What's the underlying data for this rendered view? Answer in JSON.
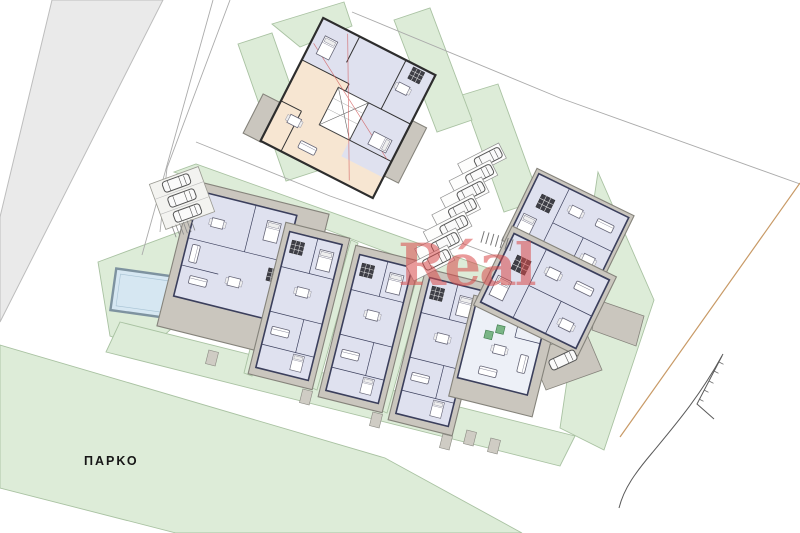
{
  "labels": {
    "park": "ΠΑΡΚΟ",
    "watermark": "Réal"
  },
  "colors": {
    "green": "#ddecd8",
    "green_border": "#a9c2a2",
    "road_gray": "#eaeaea",
    "road_border": "#bdbdbd",
    "wall_gray": "#cac6be",
    "wall_border": "#85837b",
    "floor_blue": "#dfe1ef",
    "floor_peach": "#f7e6d2",
    "plan_line": "#3b3f5c",
    "pool_blue": "#d6e7f2",
    "pool_border": "#7e93a0",
    "watermark_red": "#d94b4b",
    "boundary_tan": "#c89a66",
    "accent_red": "#d05555",
    "furniture_green": "#7ab586",
    "dark_unit": "#3e3e46"
  },
  "site": {
    "type": "architectural site plan",
    "buildings": [
      {
        "id": "apartment-block",
        "floors": 2
      },
      {
        "id": "house-a"
      },
      {
        "id": "house-b"
      },
      {
        "id": "house-c"
      },
      {
        "id": "house-d"
      },
      {
        "id": "house-e"
      },
      {
        "id": "house-f"
      },
      {
        "id": "house-g"
      }
    ],
    "parking": {
      "main_lot_cars": 7,
      "side_lot_cars": 3,
      "driveway_cars": 1
    },
    "features": [
      "pool",
      "park",
      "roads",
      "boundary-lines"
    ]
  }
}
